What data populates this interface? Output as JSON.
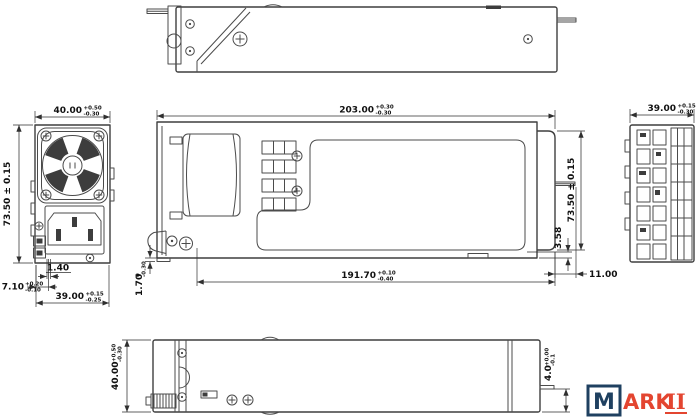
{
  "palette": {
    "background": "#ffffff",
    "line_color": "#4b4b4b",
    "dim_text_color": "#111111",
    "logo_navy": "#1f4060",
    "logo_red": "#e34530"
  },
  "dims": {
    "front_width": {
      "value": "40.00",
      "tol_up": "+0.50",
      "tol_dn": "-0.30"
    },
    "front_height": {
      "value": "73.50 ± 0.15"
    },
    "front_led_gap": {
      "value": "1.40"
    },
    "front_inlet_offset": {
      "value": "7.10",
      "tol_up": "+0.20",
      "tol_dn": "-0.10"
    },
    "front_bottom_width": {
      "value": "39.00",
      "tol_up": "+0.15",
      "tol_dn": "-0.25"
    },
    "side_overall_length": {
      "value": "203.00",
      "tol_up": "+0.30",
      "tol_dn": "-0.30"
    },
    "side_chassis_length": {
      "value": "191.70",
      "tol_up": "+0.10",
      "tol_dn": "-0.40"
    },
    "side_front_lip": {
      "value": "1.70",
      "tol_up": "0",
      "tol_dn": "-0.30"
    },
    "side_height": {
      "value": "73.50 ± 0.15"
    },
    "side_rear_inset": {
      "value": "3.58"
    },
    "side_connector_protrusion": {
      "value": "11.00"
    },
    "rear_width": {
      "value": "39.00",
      "tol_up": "+0.15",
      "tol_dn": "-0.30"
    },
    "bottom_depth": {
      "value": "40.00",
      "tol_up": "+0.50",
      "tol_dn": "-0.30"
    },
    "bottom_pin_offset": {
      "value": "4.0",
      "tol_up": "+0.00",
      "tol_dn": "-0.1"
    }
  },
  "logo": {
    "boxed_letter": "M",
    "name_rest": "ARK",
    "name_underlined": "II"
  }
}
